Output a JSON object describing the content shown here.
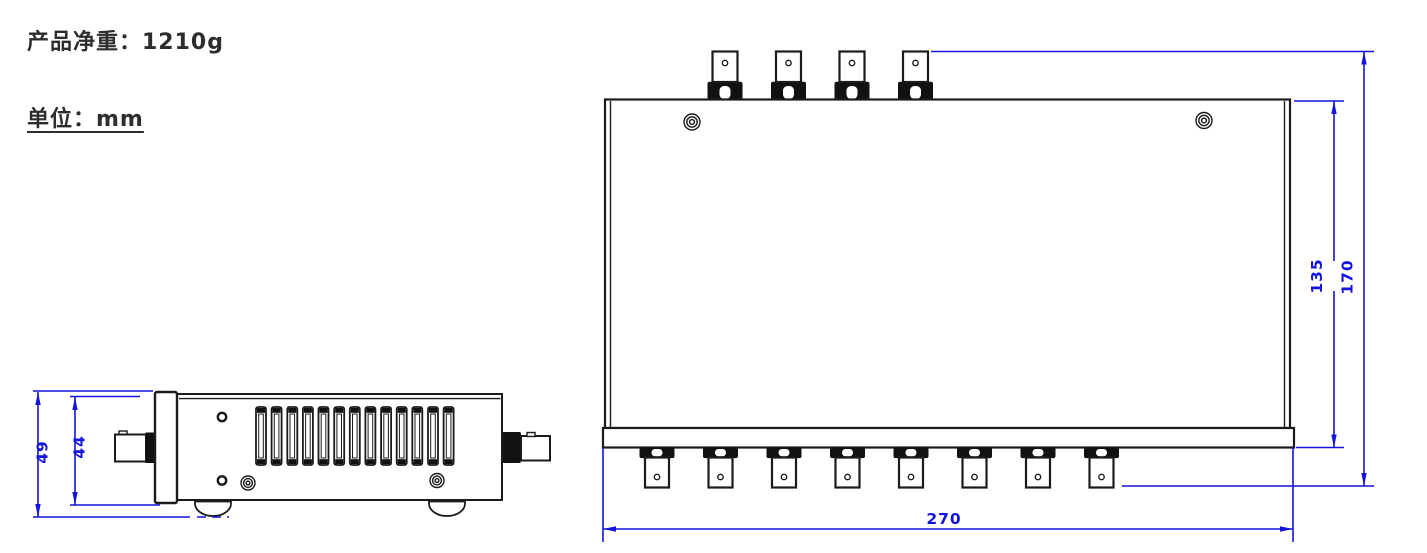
{
  "notes": {
    "net_weight": {
      "label": "产品净重：1210g",
      "value": "1210g"
    },
    "unit": {
      "label": "单位：mm",
      "value": "mm"
    }
  },
  "drawing": {
    "colors": {
      "dimension": "#1414dc",
      "outline": "#1b1b1b",
      "background": "#ffffff"
    },
    "side_view": {
      "dims": {
        "overall_height": "49",
        "body_height": "44"
      },
      "vent_slot_count": 13,
      "front_connector_count": 1,
      "rear_connector_count": 1,
      "foot_count": 2
    },
    "top_view": {
      "dims": {
        "width": "270",
        "body_depth": "135",
        "overall_depth": "170"
      },
      "top_connector_count": 4,
      "bottom_connector_count": 8,
      "screw_count": 2
    }
  }
}
